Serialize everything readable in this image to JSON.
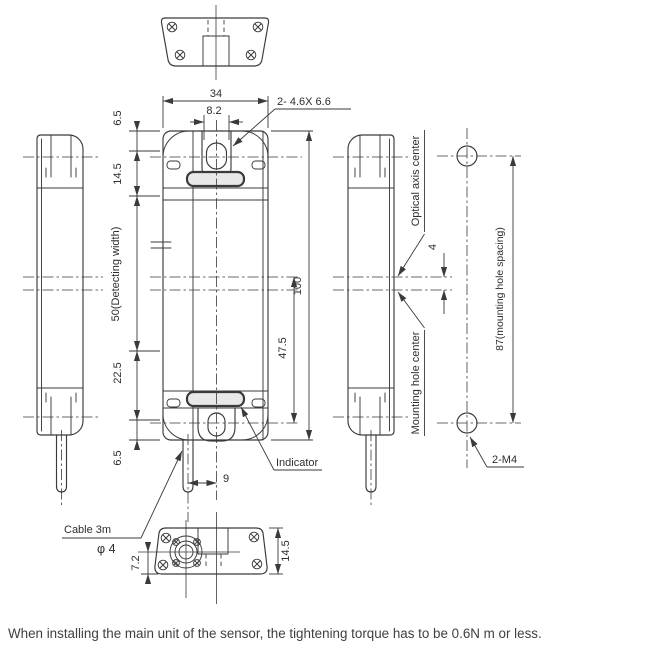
{
  "drawing": {
    "dims": {
      "body_width": "34",
      "slot_width": "8.2",
      "slot_spec": "2- 4.6X 6.6",
      "margin_top": "6.5",
      "upper_section": "14.5",
      "detecting_width": "50(Detecting width)",
      "lower_section": "22.5",
      "margin_bottom": "6.5",
      "body_height": "100",
      "indicator_offset": "47.5",
      "cable_offset": "9",
      "axis_gap": "4",
      "hole_spacing": "87(mounting hole spacing)",
      "hole_thread": "2-M4",
      "bottom_depth": "7.2",
      "bottom_height": "14.5"
    },
    "labels": {
      "indicator": "Indicator",
      "cable_length": "Cable 3m",
      "cable_diameter": "φ 4",
      "optical_axis": "Optical axis center",
      "mounting_center": "Mounting hole center"
    }
  },
  "note": "When installing the main unit of the sensor, the tightening torque has to be 0.6N m or less.",
  "colors": {
    "line": "#3a3a3a",
    "text": "#2d2d2d",
    "window_fill": "#e8e8e8",
    "note_text": "#3f3f3f",
    "background": "#ffffff"
  }
}
